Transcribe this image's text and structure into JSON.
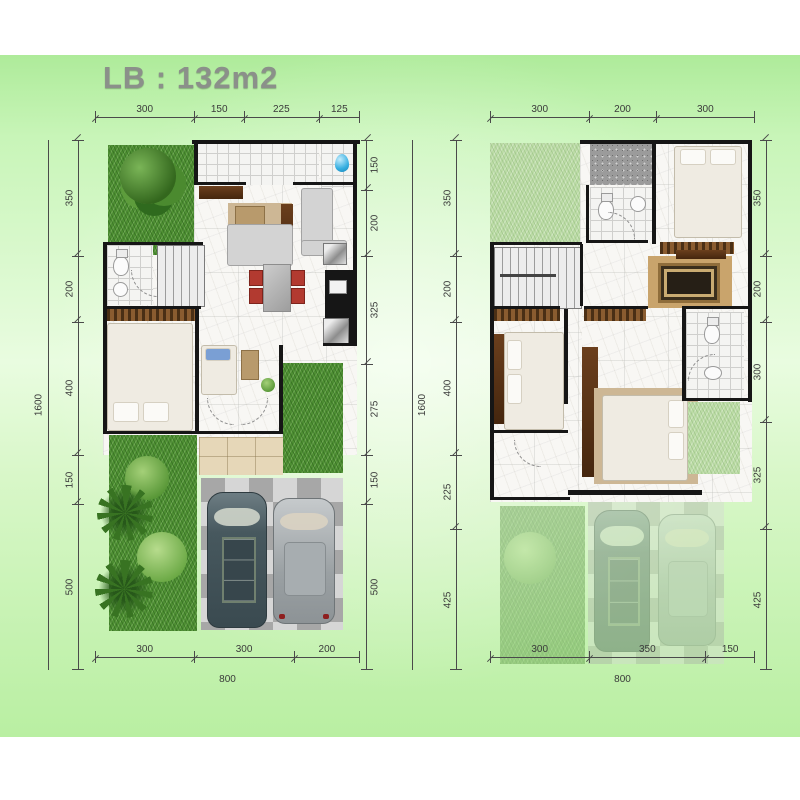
{
  "title": "LB : 132m2",
  "plans": [
    {
      "name": "ground-floor",
      "top": [
        "300",
        "150",
        "225",
        "125"
      ],
      "bottom": [
        "300",
        "300",
        "200"
      ],
      "left": [
        "350",
        "200",
        "400",
        "150",
        "500"
      ],
      "right": [
        "150",
        "200",
        "325",
        "275",
        "150",
        "500"
      ],
      "left_total": "1600",
      "right_total": "1600",
      "bottom_total": "800"
    },
    {
      "name": "upper-floor",
      "top": [
        "300",
        "200",
        "300"
      ],
      "bottom": [
        "300",
        "350",
        "150"
      ],
      "left": [
        "350",
        "200",
        "400",
        "225",
        "425"
      ],
      "right": [
        "350",
        "200",
        "300",
        "325",
        "425"
      ],
      "bottom_total": "800"
    }
  ],
  "colors": {
    "background_green": "#c6f3b4",
    "wall_black": "#161616",
    "dimension_text": "#3a3a3a",
    "title_gray": "#8b908a",
    "grass_green": "#4e8f33",
    "car_dark": "#47585e",
    "car_silver": "#9aa0a3",
    "chair_red": "#b23a30",
    "water_blue": "#35aee0",
    "wood_brown": "#5a3318",
    "path_beige": "#e6d7b8"
  }
}
